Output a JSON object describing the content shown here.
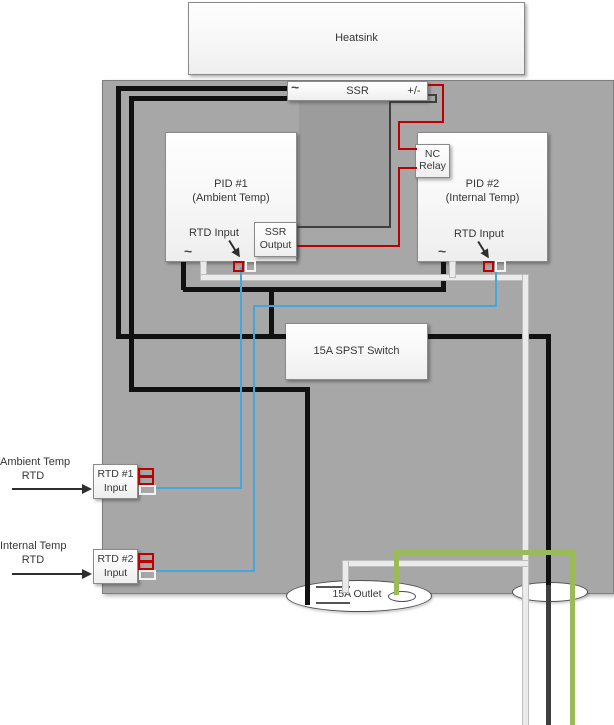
{
  "diagram": {
    "heatsink": {
      "label": "Heatsink"
    },
    "ssr": {
      "left_terminal": "~",
      "label": "SSR",
      "right_terminal": "+/-"
    },
    "pid1": {
      "title": "PID #1",
      "subtitle": "(Ambient Temp)",
      "rtd_input_label": "RTD Input",
      "power_terminal": "~"
    },
    "pid2": {
      "title": "PID #2",
      "subtitle": "(Internal Temp)",
      "rtd_input_label": "RTD Input",
      "power_terminal": "~"
    },
    "ssr_output_box": {
      "line1": "SSR",
      "line2": "Output"
    },
    "nc_relay_box": {
      "line1": "NC",
      "line2": "Relay"
    },
    "spst_switch": {
      "label": "15A SPST Switch"
    },
    "rtd1_input_box": {
      "line1": "RTD #1",
      "line2": "Input"
    },
    "rtd2_input_box": {
      "line1": "RTD #2",
      "line2": "Input"
    },
    "ambient_rtd_label": {
      "line1": "Ambient Temp",
      "line2": "RTD"
    },
    "internal_rtd_label": {
      "line1": "Internal Temp",
      "line2": "RTD"
    },
    "outlet": {
      "label": "15A Outlet"
    },
    "colors": {
      "panel_gray": "#a7a7a7",
      "wire_black": "#111111",
      "wire_dark_gray": "#3f3f3f",
      "wire_red": "#c00000",
      "wire_blue": "#45a5dc",
      "wire_white": "#ebebeb",
      "wire_green": "#9bbb59"
    }
  }
}
